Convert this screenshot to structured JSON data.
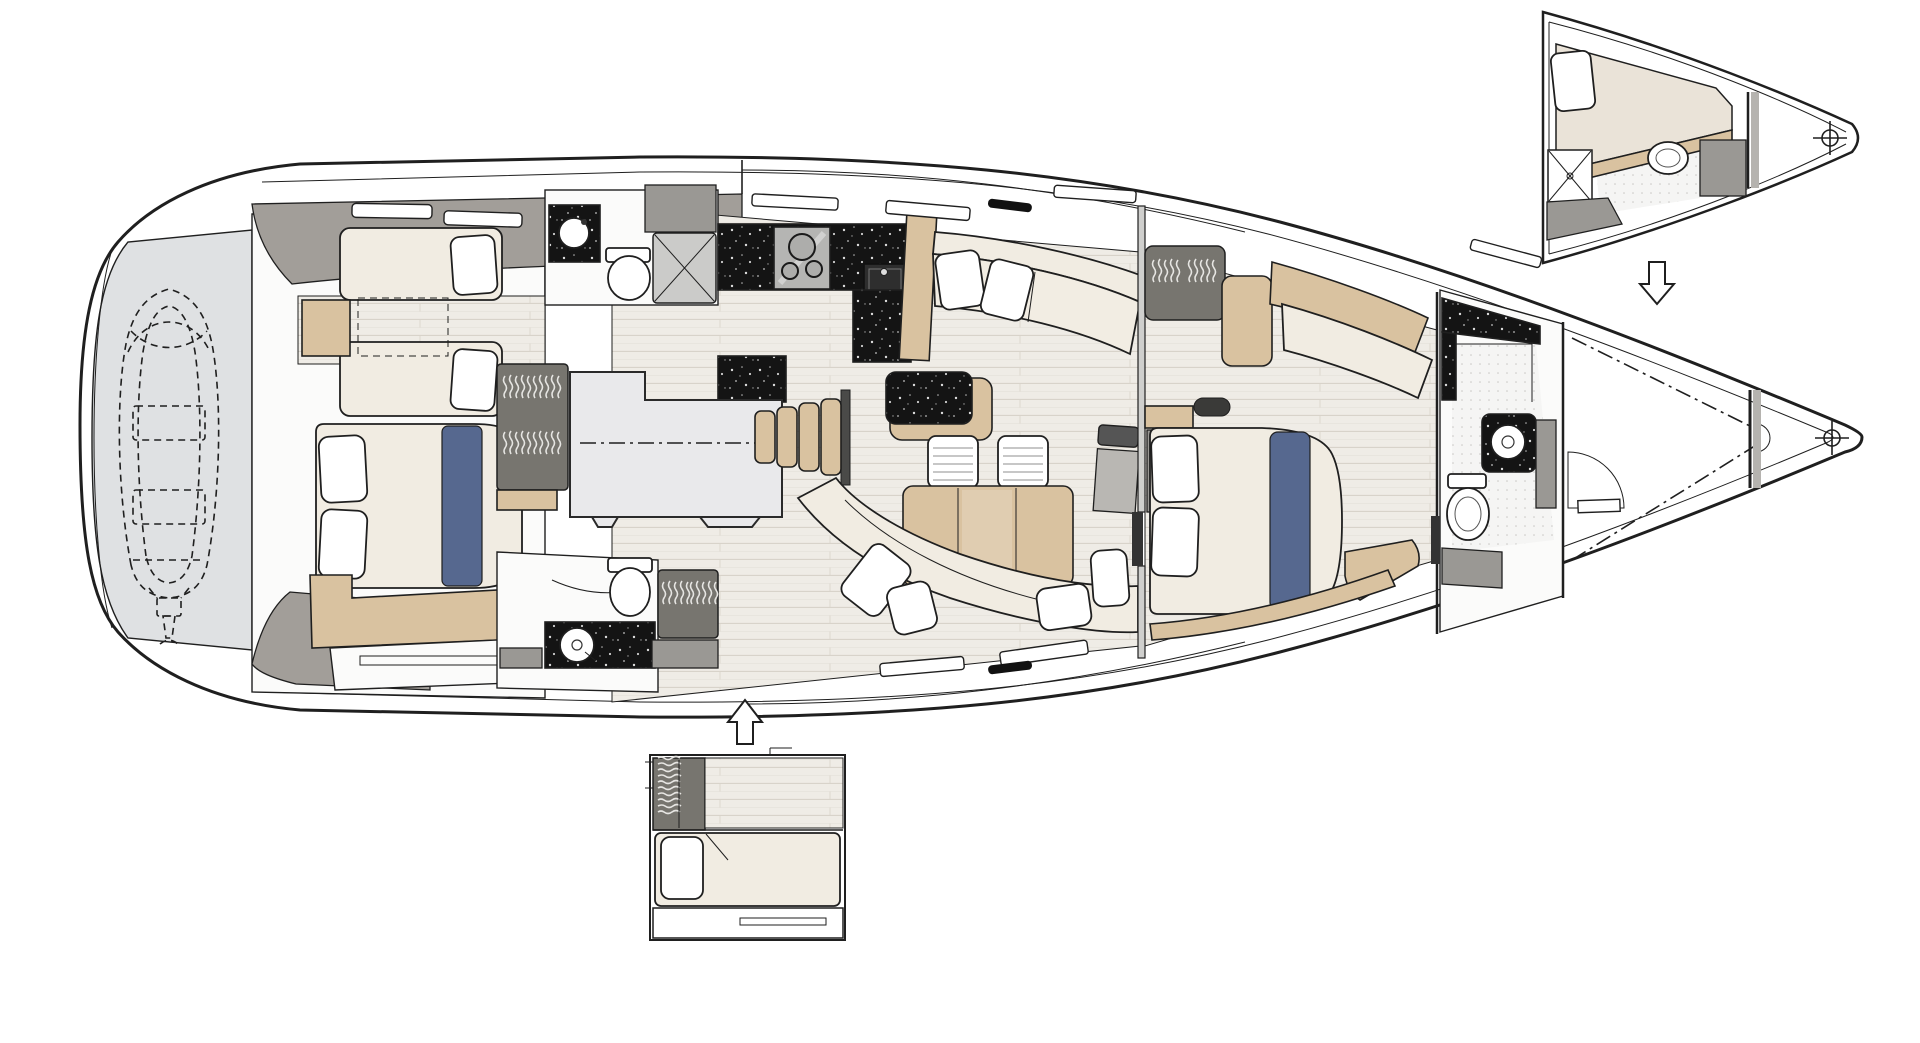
{
  "meta": {
    "type": "yacht-interior-deck-plan",
    "description": "Top-view interior arrangement plan of a sailing yacht, bow pointing right, with two alternative-layout insets connected by arrows",
    "background": "#ffffff"
  },
  "colors": {
    "outline": "#1f1f1f",
    "hull_fill": "#ffffff",
    "garage_fill": "#dfe1e3",
    "deck_band": "#a29e99",
    "room_fill": "#fbfbfa",
    "floor_plank": "#efece6",
    "plank_line": "#d8d3ca",
    "wood_tan": "#d9c2a0",
    "cushion_cream": "#f1ece2",
    "pillow_white": "#ffffff",
    "cabinet_gray": "#9a9894",
    "wardrobe_gray": "#77756f",
    "runner_blue": "#56688f",
    "engine_fill": "#e9e9eb",
    "stool_white": "#f6f5f2"
  },
  "rooms": [
    {
      "name": "tender garage with inflatable dinghy stored (dashed outline)",
      "fixtures": [
        "dinghy-dashed-outline",
        "outboard-motor",
        "centerline-crosshair"
      ]
    },
    {
      "name": "aft twin guest cabin with two single berths",
      "fixtures": [
        "berth",
        "berth",
        "pillows",
        "nightstand",
        "dashed-hatch",
        "hull-windows"
      ]
    },
    {
      "name": "aft double guest cabin",
      "fixtures": [
        "double-bed",
        "two-pillows",
        "blue-runner",
        "wood-berth-step",
        "drawer-front"
      ]
    },
    {
      "name": "aft head port side",
      "fixtures": [
        "washbasin-on-dark-counter",
        "toilet",
        "shower-tray-x"
      ]
    },
    {
      "name": "aft head starboard side",
      "fixtures": [
        "washbasin-on-dark-counter",
        "toilet",
        "shower-glass",
        "hanging-locker"
      ]
    },
    {
      "name": "galley",
      "fixtures": [
        "three-burner-stove",
        "square-sink",
        "dark-speckled-counters",
        "fridge-cabinet",
        "peninsula-counter"
      ]
    },
    {
      "name": "engine room under cockpit sole",
      "fixtures": [
        "dash-dot-centerline"
      ]
    },
    {
      "name": "salon dinette",
      "fixtures": [
        "sofa-with-pillows",
        "dining-table",
        "two-stools",
        "curved-settee",
        "tv-panel"
      ]
    },
    {
      "name": "companionway stairs",
      "fixtures": [
        "four-wood-treads"
      ]
    },
    {
      "name": "owner forward cabin",
      "fixtures": [
        "island-double-bed",
        "two-pillows",
        "blue-runner",
        "hanging-wardrobe",
        "vanity-desk",
        "chaise-cushion",
        "seat"
      ]
    },
    {
      "name": "forward head",
      "fixtures": [
        "round-washbasin",
        "toilet",
        "speckled-shower-walls",
        "cabinet"
      ]
    },
    {
      "name": "bow anchor locker",
      "fixtures": [
        "dash-dot-chain-lines",
        "door-swing-arc",
        "collision-bulkhead",
        "bow-crosshair"
      ]
    }
  ],
  "insets": [
    {
      "name": "bow alternative layout: skipper cabin",
      "shape": "triangle",
      "position": "top-right",
      "fixtures": [
        "single-berth-with-pillow",
        "shower-tray-x",
        "oval-washbasin",
        "bulkhead",
        "bow-crosshair"
      ],
      "arrow": {
        "direction": "down",
        "meaning": "variant applies to bow section below"
      }
    },
    {
      "name": "aft alternative layout: single berth cabin",
      "shape": "rectangle",
      "position": "bottom-center",
      "fixtures": [
        "hanging-locker",
        "wood-floor-strip",
        "single-berth-with-pillow",
        "drawer-front"
      ],
      "arrow": {
        "direction": "up",
        "meaning": "variant applies to aft section above"
      }
    }
  ],
  "symbols": {
    "crosshairs": [
      {
        "x": 292,
        "y": 440,
        "meaning": "stern centerline datum"
      },
      {
        "x": 1832,
        "y": 438,
        "meaning": "bow centerline datum"
      },
      {
        "x": 1830,
        "y": 138,
        "meaning": "inset bow centerline datum"
      }
    ],
    "arrows": [
      {
        "x": 745,
        "y": 722,
        "direction": "up"
      },
      {
        "x": 1657,
        "y": 283,
        "direction": "down"
      }
    ]
  }
}
